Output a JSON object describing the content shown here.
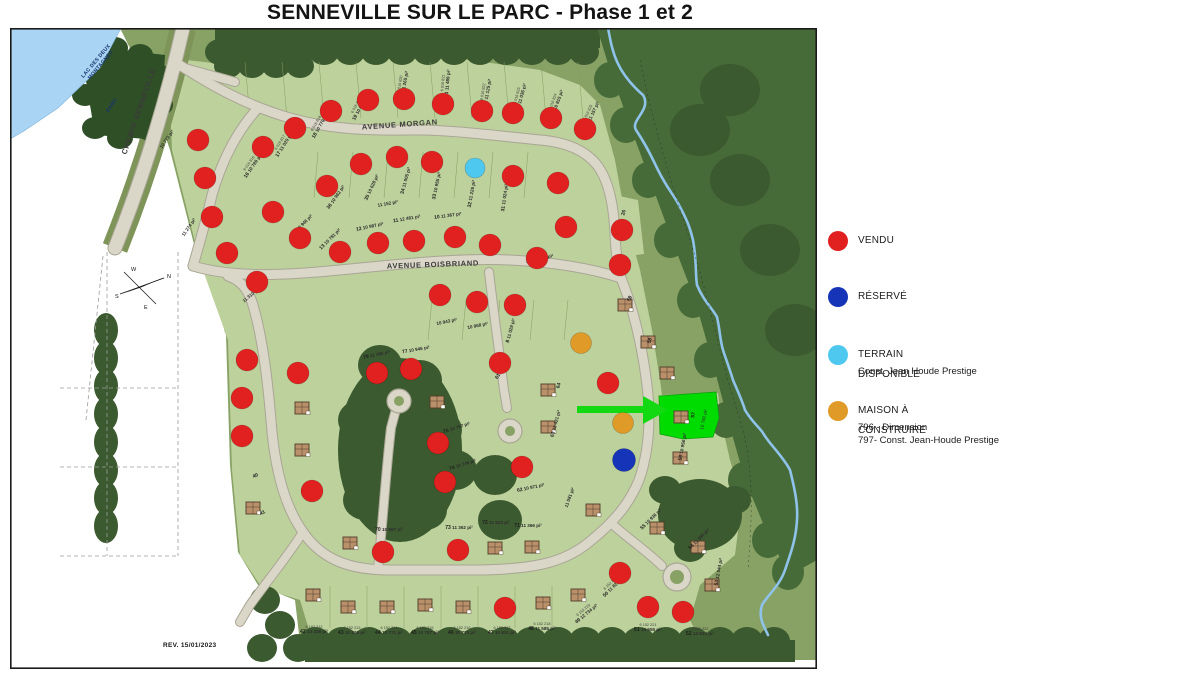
{
  "title": "SENNEVILLE SUR LE PARC - Phase 1 et 2",
  "legend": {
    "items": [
      {
        "label": "VENDU",
        "color": "#e0211f",
        "sub": []
      },
      {
        "label": "RÉSERVÉ",
        "color": "#1634b8",
        "sub": []
      },
      {
        "label": "TERRAIN DISPONIBLE",
        "color": "#4fc8f0",
        "sub": [
          "Const. Jean Houde Prestige"
        ]
      },
      {
        "label": "MAISON À CONSTRUIRE",
        "color": "#e09a28",
        "sub": [
          "796 - Dimension",
          "797- Const. Jean-Houde Prestige"
        ]
      }
    ]
  },
  "map": {
    "rev": "REV. 15/01/2023",
    "compass": {
      "n": "N",
      "s": "S",
      "e": "E",
      "w": "W"
    },
    "road_labels": [
      {
        "name": "AVENUE MORGAN",
        "x": 400,
        "y": 127,
        "rot": -4
      },
      {
        "name": "AVENUE BOISBRIAND",
        "x": 433,
        "y": 267,
        "rot": -2
      },
      {
        "name": "CHEMIN SENNEVILLE",
        "x": 141,
        "y": 112,
        "rot": -71
      }
    ],
    "place_labels": [
      {
        "line1": "LAC DES DEUX",
        "line2": "MONTAGNES",
        "x": 97,
        "y": 62,
        "rot": -50
      },
      {
        "line1": "PARC",
        "line2": "",
        "x": 113,
        "y": 106,
        "rot": -58
      }
    ]
  },
  "colors": {
    "vendu": "#e0211f",
    "reserve": "#1634b8",
    "terrain": "#4fc8f0",
    "maison": "#e09a28",
    "highlight": "#00dc00",
    "arrow": "#12d912"
  },
  "markers": {
    "vendu": [
      [
        263,
        147
      ],
      [
        295,
        128
      ],
      [
        331,
        111
      ],
      [
        368,
        100
      ],
      [
        404,
        99
      ],
      [
        443,
        104
      ],
      [
        482,
        111
      ],
      [
        513,
        113
      ],
      [
        551,
        118
      ],
      [
        585,
        129
      ],
      [
        327,
        186
      ],
      [
        361,
        164
      ],
      [
        397,
        157
      ],
      [
        432,
        162
      ],
      [
        513,
        176
      ],
      [
        558,
        183
      ],
      [
        198,
        140
      ],
      [
        205,
        178
      ],
      [
        212,
        217
      ],
      [
        227,
        253
      ],
      [
        257,
        282
      ],
      [
        273,
        212
      ],
      [
        300,
        238
      ],
      [
        340,
        252
      ],
      [
        378,
        243
      ],
      [
        414,
        241
      ],
      [
        455,
        237
      ],
      [
        490,
        245
      ],
      [
        537,
        258
      ],
      [
        566,
        227
      ],
      [
        622,
        230
      ],
      [
        620,
        265
      ],
      [
        440,
        295
      ],
      [
        477,
        302
      ],
      [
        515,
        305
      ],
      [
        608,
        383
      ],
      [
        247,
        360
      ],
      [
        242,
        398
      ],
      [
        242,
        436
      ],
      [
        298,
        373
      ],
      [
        312,
        491
      ],
      [
        377,
        373
      ],
      [
        411,
        369
      ],
      [
        438,
        443
      ],
      [
        445,
        482
      ],
      [
        500,
        363
      ],
      [
        522,
        467
      ],
      [
        383,
        552
      ],
      [
        458,
        550
      ],
      [
        505,
        608
      ],
      [
        620,
        573
      ],
      [
        648,
        607
      ],
      [
        683,
        612
      ]
    ],
    "reserve": [
      [
        624,
        460
      ]
    ],
    "terrain": [
      [
        475,
        168
      ]
    ],
    "maison": [
      [
        581,
        343
      ],
      [
        623,
        423
      ]
    ]
  },
  "highlight_lot": {
    "num": "57",
    "area": "10 780 pi²"
  },
  "houses": [
    [
      302,
      408
    ],
    [
      302,
      450
    ],
    [
      253,
      508
    ],
    [
      350,
      543
    ],
    [
      313,
      595
    ],
    [
      348,
      607
    ],
    [
      387,
      607
    ],
    [
      425,
      605
    ],
    [
      463,
      607
    ],
    [
      495,
      548
    ],
    [
      532,
      547
    ],
    [
      548,
      390
    ],
    [
      548,
      427
    ],
    [
      648,
      342
    ],
    [
      667,
      373
    ],
    [
      625,
      305
    ],
    [
      680,
      458
    ],
    [
      657,
      528
    ],
    [
      698,
      547
    ],
    [
      712,
      585
    ],
    [
      543,
      603
    ],
    [
      578,
      595
    ],
    [
      593,
      510
    ],
    [
      437,
      402
    ]
  ],
  "lot_labels": [
    {
      "n": "16",
      "c": "6 016 816",
      "a": "10 789 pi²",
      "x": 250,
      "y": 164,
      "r": -55
    },
    {
      "n": "17",
      "c": "6 016 817",
      "a": "11 020 pi²",
      "x": 281,
      "y": 143,
      "r": -58
    },
    {
      "n": "18",
      "c": "6 016 818",
      "a": "10 770 pi²",
      "x": 317,
      "y": 124,
      "r": -60
    },
    {
      "n": "19",
      "c": "6 016 819",
      "a": "10 812 pi²",
      "x": 357,
      "y": 106,
      "r": -62
    },
    {
      "n": "20",
      "c": "6 016 820",
      "a": "11 265 pi²",
      "x": 401,
      "y": 84,
      "r": -80
    },
    {
      "n": "21",
      "c": "6 016 821",
      "a": "11 489 pi²",
      "x": 444,
      "y": 83,
      "r": -85
    },
    {
      "n": "22",
      "c": "6 016 822",
      "a": "11 125 pi²",
      "x": 484,
      "y": 92,
      "r": -80
    },
    {
      "n": "23",
      "c": "6 016 823",
      "a": "11 036 pi²",
      "x": 518,
      "y": 96,
      "r": -75
    },
    {
      "n": "24",
      "c": "6 016 824",
      "a": "10 815 pi²",
      "x": 554,
      "y": 102,
      "r": -70
    },
    {
      "n": "25",
      "c": "6 016 825",
      "a": "11 157 pi²",
      "x": 589,
      "y": 113,
      "r": -65
    },
    {
      "n": "26",
      "c": "",
      "a": "",
      "x": 625,
      "y": 213,
      "r": -75
    },
    {
      "n": "36",
      "c": "",
      "a": "10 962 pi²",
      "x": 337,
      "y": 198,
      "r": -55
    },
    {
      "n": "35",
      "c": "",
      "a": "10 628 pi²",
      "x": 373,
      "y": 188,
      "r": -65
    },
    {
      "n": "34",
      "c": "",
      "a": "11 005 pi²",
      "x": 407,
      "y": 181,
      "r": -75
    },
    {
      "n": "33",
      "c": "",
      "a": "10 955 pi²",
      "x": 438,
      "y": 186,
      "r": -78
    },
    {
      "n": "32",
      "c": "",
      "a": "11 226 pi²",
      "x": 473,
      "y": 194,
      "r": -80
    },
    {
      "n": "31",
      "c": "",
      "a": "11 024 pi²",
      "x": 506,
      "y": 198,
      "r": -82
    },
    {
      "n": "",
      "c": "",
      "a": "10 773 pi²",
      "x": 168,
      "y": 140,
      "r": -55
    },
    {
      "n": "14",
      "c": "",
      "a": "10 946 pi²",
      "x": 303,
      "y": 226,
      "r": -45
    },
    {
      "n": "13",
      "c": "",
      "a": "10 781 pi²",
      "x": 331,
      "y": 240,
      "r": -45
    },
    {
      "n": "12",
      "c": "",
      "a": "10 987 pi²",
      "x": 370,
      "y": 228,
      "r": -12
    },
    {
      "n": "11",
      "c": "",
      "a": "12 481 pi²",
      "x": 407,
      "y": 220,
      "r": -10
    },
    {
      "n": "10",
      "c": "",
      "a": "11 367 pi²",
      "x": 448,
      "y": 217,
      "r": -8
    },
    {
      "n": "",
      "c": "",
      "a": "11 152 pi²",
      "x": 388,
      "y": 205,
      "r": -10
    },
    {
      "n": "28",
      "c": "",
      "a": "10 986 pi²",
      "x": 540,
      "y": 260,
      "r": -12
    },
    {
      "n": "27",
      "c": "",
      "a": "",
      "x": 630,
      "y": 262,
      "r": -70
    },
    {
      "n": "",
      "c": "",
      "a": "11 274 pi²",
      "x": 190,
      "y": 228,
      "r": -55
    },
    {
      "n": "",
      "c": "",
      "a": "11 310 pi²",
      "x": 252,
      "y": 296,
      "r": -40
    },
    {
      "n": "",
      "c": "",
      "a": "10 943 pi²",
      "x": 447,
      "y": 323,
      "r": -12
    },
    {
      "n": "",
      "c": "",
      "a": "10 968 pi²",
      "x": 478,
      "y": 327,
      "r": -12
    },
    {
      "n": "8",
      "c": "",
      "a": "11 029 pi²",
      "x": 512,
      "y": 331,
      "r": -75
    },
    {
      "n": "79",
      "c": "",
      "a": "11 486 pi²",
      "x": 377,
      "y": 356,
      "r": -12
    },
    {
      "n": "77",
      "c": "",
      "a": "10 946 pi²",
      "x": 416,
      "y": 351,
      "r": -10
    },
    {
      "n": "75",
      "c": "",
      "a": "10 767 pi²",
      "x": 457,
      "y": 429,
      "r": -18
    },
    {
      "n": "74",
      "c": "",
      "a": "10 746 pi²",
      "x": 463,
      "y": 466,
      "r": -18
    },
    {
      "n": "61",
      "c": "",
      "a": "",
      "x": 499,
      "y": 377,
      "r": -60
    },
    {
      "n": "62",
      "c": "",
      "a": "10 971 pi²",
      "x": 531,
      "y": 489,
      "r": -12
    },
    {
      "n": "",
      "c": "",
      "a": "11 081 pi²",
      "x": 571,
      "y": 498,
      "r": -70
    },
    {
      "n": "64",
      "c": "",
      "a": "",
      "x": 560,
      "y": 386,
      "r": -75
    },
    {
      "n": "63",
      "c": "",
      "a": "11 421 pi²",
      "x": 557,
      "y": 424,
      "r": -75
    },
    {
      "n": "59",
      "c": "",
      "a": "",
      "x": 631,
      "y": 299,
      "r": -70
    },
    {
      "n": "58",
      "c": "",
      "a": "",
      "x": 651,
      "y": 341,
      "r": -75
    },
    {
      "n": "56",
      "c": "",
      "a": "10 956 pi²",
      "x": 684,
      "y": 447,
      "r": -80
    },
    {
      "n": "55",
      "c": "",
      "a": "10 936 pi²",
      "x": 652,
      "y": 520,
      "r": -45
    },
    {
      "n": "54",
      "c": "",
      "a": "11 590 pi²",
      "x": 700,
      "y": 540,
      "r": -45
    },
    {
      "n": "53",
      "c": "",
      "a": "12 044 pi²",
      "x": 720,
      "y": 572,
      "r": -80
    },
    {
      "n": "37",
      "c": "",
      "a": "",
      "x": 253,
      "y": 365,
      "r": -25
    },
    {
      "n": "39",
      "c": "",
      "a": "",
      "x": 250,
      "y": 402,
      "r": -25
    },
    {
      "n": "38",
      "c": "",
      "a": "",
      "x": 250,
      "y": 440,
      "r": -25
    },
    {
      "n": "40",
      "c": "",
      "a": "",
      "x": 256,
      "y": 477,
      "r": -25
    },
    {
      "n": "41",
      "c": "",
      "a": "",
      "x": 263,
      "y": 514,
      "r": -25
    },
    {
      "n": "70",
      "c": "",
      "a": "10 867 pi²",
      "x": 389,
      "y": 531,
      "r": 0
    },
    {
      "n": "73",
      "c": "",
      "a": "11 362 pi²",
      "x": 459,
      "y": 529,
      "r": 0
    },
    {
      "n": "72",
      "c": "",
      "a": "11 824 pi²",
      "x": 496,
      "y": 524,
      "r": 0
    },
    {
      "n": "71",
      "c": "",
      "a": "11 366 pi²",
      "x": 528,
      "y": 527,
      "r": 0
    },
    {
      "n": "42",
      "c": "6 152 212",
      "a": "13 328 pi²",
      "x": 314,
      "y": 628,
      "r": 0
    },
    {
      "n": "43",
      "c": "6 152 213",
      "a": "10 836 pi²",
      "x": 352,
      "y": 629,
      "r": 0
    },
    {
      "n": "44",
      "c": "6 152 214",
      "a": "10 771 pi²",
      "x": 389,
      "y": 629,
      "r": 0
    },
    {
      "n": "45",
      "c": "6 152 215",
      "a": "10 787 pi²",
      "x": 425,
      "y": 629,
      "r": 0
    },
    {
      "n": "46",
      "c": "6 152 216",
      "a": "10 774 pi²",
      "x": 462,
      "y": 629,
      "r": 0
    },
    {
      "n": "47",
      "c": "6 152 217",
      "a": "10 831 pi²",
      "x": 502,
      "y": 629,
      "r": 0
    },
    {
      "n": "48",
      "c": "6 152 218",
      "a": "11 585 pi²",
      "x": 542,
      "y": 625,
      "r": 0
    },
    {
      "n": "49",
      "c": "6 152 219",
      "a": "12 734 pi²",
      "x": 584,
      "y": 611,
      "r": -40
    },
    {
      "n": "50",
      "c": "6 152 220",
      "a": "11 821 pi²",
      "x": 611,
      "y": 584,
      "r": -45
    },
    {
      "n": "51",
      "c": "6 152 221",
      "a": "14 555 pi²",
      "x": 648,
      "y": 626,
      "r": 0
    },
    {
      "n": "52",
      "c": "6 152 222",
      "a": "13 624 pi²",
      "x": 700,
      "y": 630,
      "r": 0
    }
  ]
}
